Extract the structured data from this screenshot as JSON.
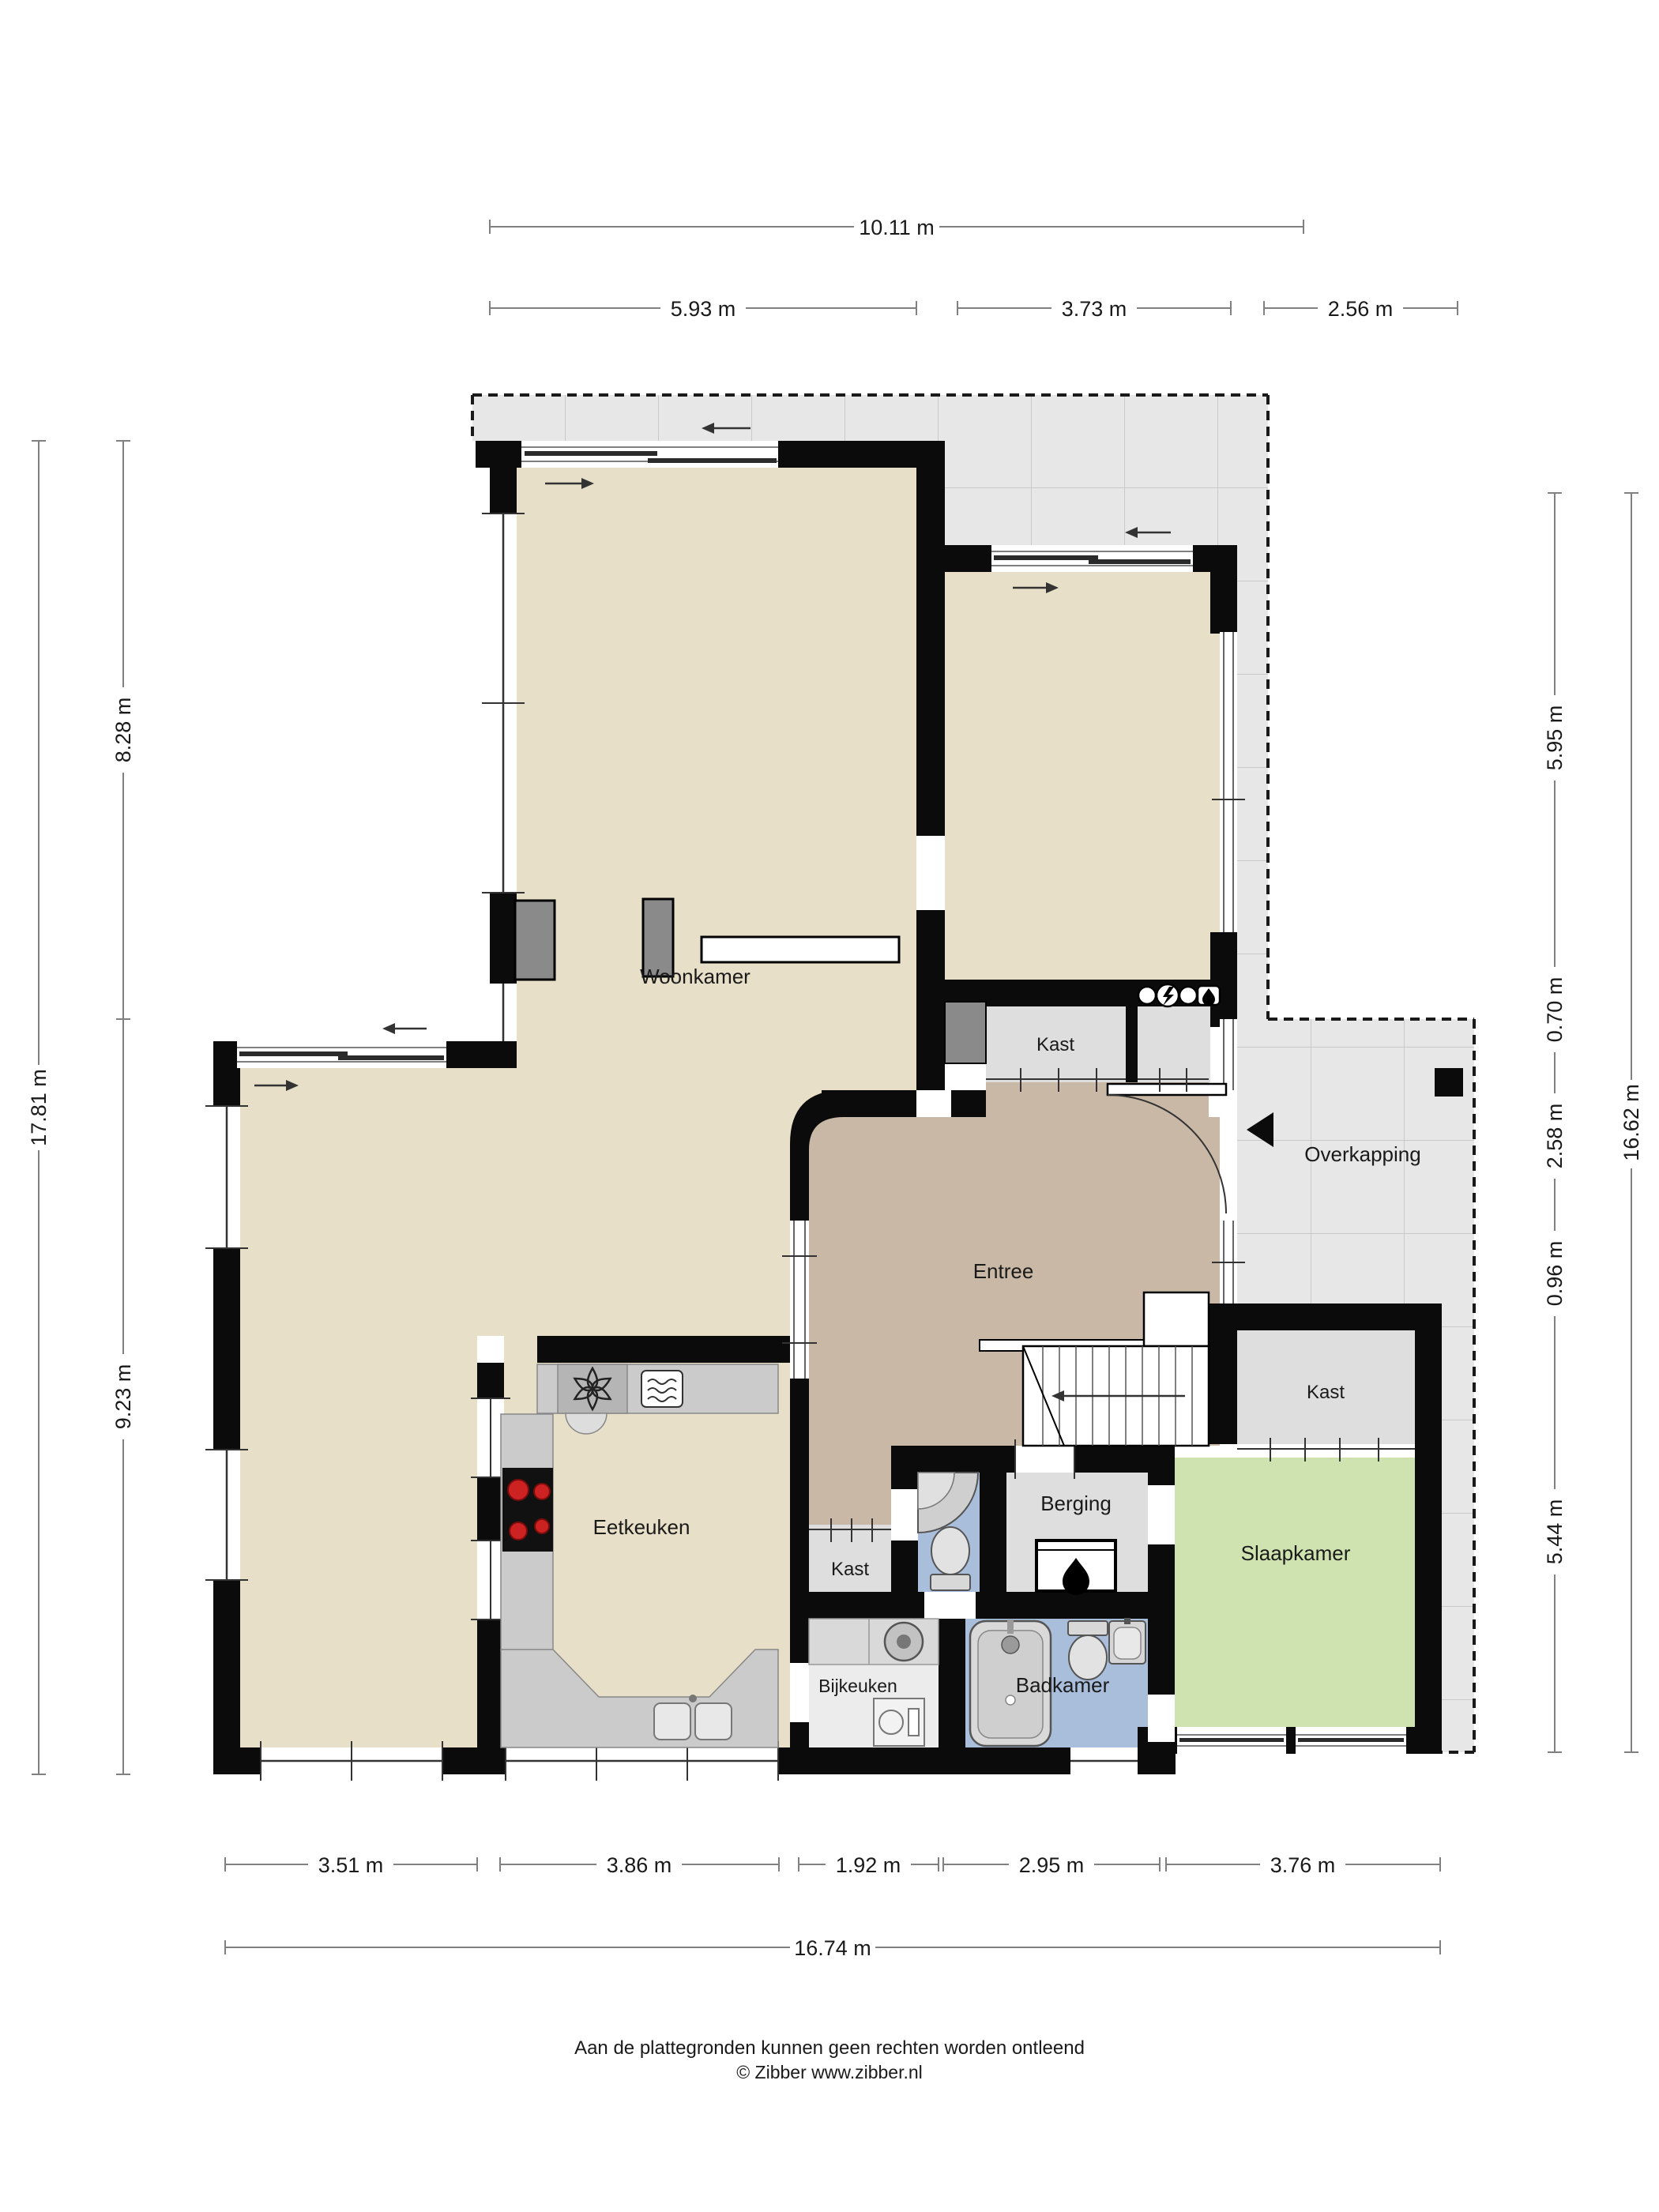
{
  "rooms": {
    "woonkamer": "Woonkamer",
    "entree": "Entree",
    "eetkeuken": "Eetkeuken",
    "bijkeuken": "Bijkeuken",
    "badkamer": "Badkamer",
    "berging": "Berging",
    "slaapkamer": "Slaapkamer",
    "overkapping": "Overkapping",
    "kast_hal": "Kast",
    "kast_gang": "Kast",
    "kast_slaapkamer": "Kast"
  },
  "dimensions": {
    "top": {
      "total": "10.11 m",
      "segments": [
        "5.93 m",
        "3.73 m",
        "2.56 m"
      ]
    },
    "bottom": {
      "total": "16.74 m",
      "segments": [
        "3.51 m",
        "3.86 m",
        "1.92 m",
        "2.95 m",
        "3.76 m"
      ]
    },
    "left": {
      "total": "17.81 m",
      "segments": [
        "8.28 m",
        "9.23 m"
      ]
    },
    "right": {
      "total": "16.62 m",
      "segments": [
        "5.95 m",
        "0.70 m",
        "2.58 m",
        "0.96 m",
        "5.44 m"
      ]
    }
  },
  "footer": {
    "disclaimer": "Aan de plattegronden kunnen geen rechten worden ontleend",
    "copyright": "© Zibber www.zibber.nl"
  },
  "colors": {
    "wall": "#0b0b0b",
    "living": "#e7dfc7",
    "entree": "#c9b8a5",
    "bedroom": "#cfe3b0",
    "bathroom": "#a9bedb",
    "storage": "#dedede",
    "utility": "#ececec",
    "terrace": "#e7e7e7",
    "counter": "#c9c9c9",
    "burner": "#cc2222"
  }
}
